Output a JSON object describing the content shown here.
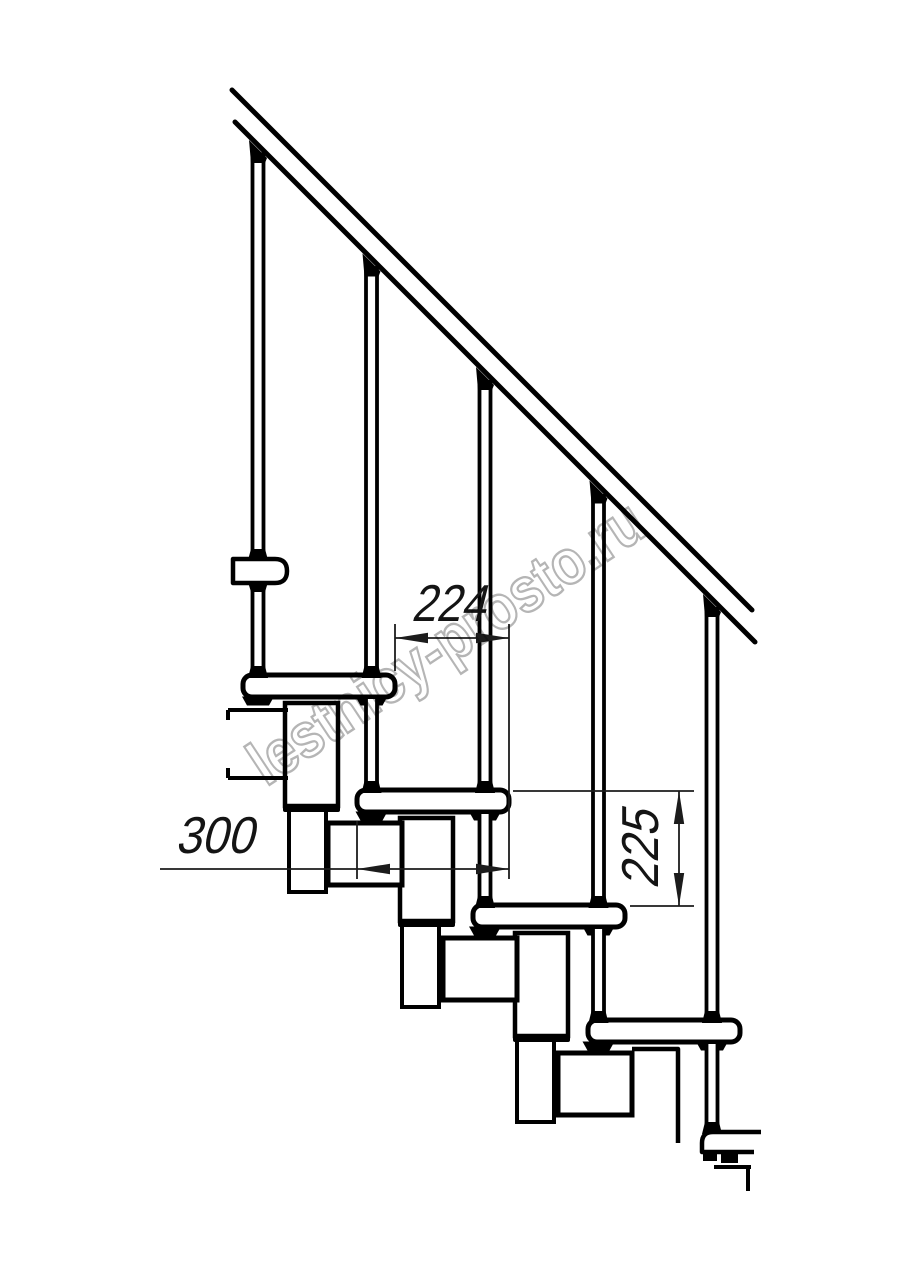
{
  "watermark": {
    "text": "lestnicy-prosto.ru",
    "color": "#a8a8a8",
    "angle_deg": -33.5,
    "center_x": 458,
    "center_y": 660,
    "font_size": 63,
    "text_length": 460,
    "stroke_width": 2.4,
    "opacity": 0.85
  },
  "dimensions": {
    "run": {
      "label": "224",
      "text_pos": [
        411,
        621
      ],
      "text_length": 74,
      "text_rotate": 0,
      "line": [
        395,
        638,
        509,
        638
      ],
      "arrows": [
        [
          "left",
          395,
          638
        ],
        [
          "right",
          509,
          638
        ]
      ],
      "extensions": [
        [
          395,
          624,
          395,
          671
        ],
        [
          509,
          624,
          509,
          879
        ]
      ]
    },
    "depth": {
      "label": "300",
      "text_pos": [
        175,
        853
      ],
      "text_length": 78,
      "text_rotate": 0,
      "line": [
        160,
        869,
        509,
        869
      ],
      "arrows": [
        [
          "left",
          357,
          869
        ],
        [
          "right",
          509,
          869
        ]
      ],
      "extensions": [
        [
          357,
          821,
          357,
          879
        ]
      ]
    },
    "rise": {
      "label": "225",
      "text_pos": [
        658,
        889
      ],
      "text_length": 78,
      "text_rotate": -90,
      "line": [
        679,
        791,
        679,
        906
      ],
      "arrows": [
        [
          "up",
          679,
          791
        ],
        [
          "down",
          679,
          906
        ]
      ],
      "extensions": [
        [
          513,
          791,
          694,
          791
        ],
        [
          630,
          906,
          694,
          906
        ]
      ]
    }
  },
  "structure": {
    "canvas": [
      914,
      1280
    ],
    "ink": "#000000",
    "dim_ink": "#1c1c1c",
    "rail_lines": [
      [
        232,
        90,
        752,
        610
      ],
      [
        235,
        122,
        755,
        642
      ]
    ],
    "rail_stroke": 5,
    "posts": [
      {
        "cx": 258,
        "segments": [
          [
            152,
            674
          ]
        ],
        "pass_caps": [],
        "base_cap": 676,
        "has_bracket": true
      },
      {
        "cx": 371.5,
        "segments": [
          [
            266,
            674
          ],
          [
            699,
            789
          ]
        ],
        "pass_caps": [
          676
        ],
        "base_cap": 791,
        "has_bracket": false
      },
      {
        "cx": 485,
        "segments": [
          [
            380,
            789
          ],
          [
            814,
            904
          ]
        ],
        "pass_caps": [
          791
        ],
        "base_cap": 906,
        "has_bracket": false
      },
      {
        "cx": 598.5,
        "segments": [
          [
            494,
            904
          ],
          [
            929,
            1019
          ]
        ],
        "pass_caps": [
          906
        ],
        "base_cap": 1021,
        "has_bracket": false
      },
      {
        "cx": 712,
        "segments": [
          [
            607,
            1019
          ],
          [
            1044,
            1131
          ]
        ],
        "pass_caps": [
          1021
        ],
        "base_cap": 1132,
        "has_bracket": false
      }
    ],
    "post_width": 11,
    "post_stroke": 3.8,
    "treads": [
      [
        243,
        675
      ],
      [
        357,
        790
      ],
      [
        473,
        905
      ],
      [
        588,
        1020
      ]
    ],
    "tread_size": [
      152,
      22,
      9
    ],
    "tread_stroke": 5,
    "partial_tread_path": "M761 1132 L713 1132 Q702 1132 702 1143 L702 1152 L754 1152",
    "big_boxes": [
      [
        285,
        703
      ],
      [
        400,
        818
      ],
      [
        515,
        933
      ]
    ],
    "big_box_size": [
      53,
      103
    ],
    "box_bars": [
      [
        283,
        804
      ],
      [
        398,
        919
      ],
      [
        513,
        1034
      ]
    ],
    "bar_size": [
      57,
      8
    ],
    "narrow_boxes": [
      [
        289,
        808
      ],
      [
        402,
        923
      ],
      [
        517,
        1038
      ]
    ],
    "narrow_size": [
      37,
      84
    ],
    "connectors": [
      [
        328,
        823
      ],
      [
        443,
        938
      ],
      [
        558,
        1053
      ]
    ],
    "connector_size": [
      74,
      62
    ],
    "cut_box_paths": [
      "M632 1049 L678 1049 L678 1143",
      "M630 1058 L630 1113"
    ],
    "plate_lines": [
      [
        228,
        710,
        288,
        710
      ],
      [
        228,
        778,
        288,
        778
      ],
      [
        228,
        710,
        228,
        720
      ],
      [
        228,
        768,
        228,
        778
      ]
    ],
    "bracket": {
      "x": 233,
      "y": 559,
      "w": 54,
      "h": 24
    },
    "cutoff_lines": [
      [
        714,
        1167,
        751,
        1167
      ],
      [
        748,
        1167,
        748,
        1191
      ]
    ],
    "cutoff_feet": [
      [
        703,
        1152,
        14,
        9
      ],
      [
        721,
        1152,
        17,
        11
      ]
    ]
  }
}
